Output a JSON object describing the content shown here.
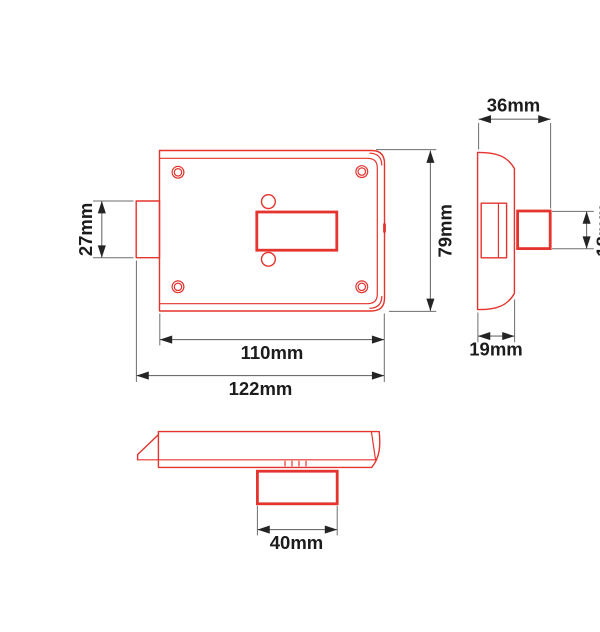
{
  "labels": {
    "front_latch_height": "27mm",
    "front_inner_width": "110mm",
    "front_overall_width": "122mm",
    "front_height": "79mm",
    "side_depth": "36mm",
    "side_bolt_height": "18mm",
    "side_faceplate_depth": "19mm",
    "bottom_cylinder_width": "40mm"
  },
  "colors": {
    "outline": "#e5332d",
    "dimension_line": "#6e6e6e",
    "arrow": "#242424",
    "label_text": "#1c1c1c"
  }
}
